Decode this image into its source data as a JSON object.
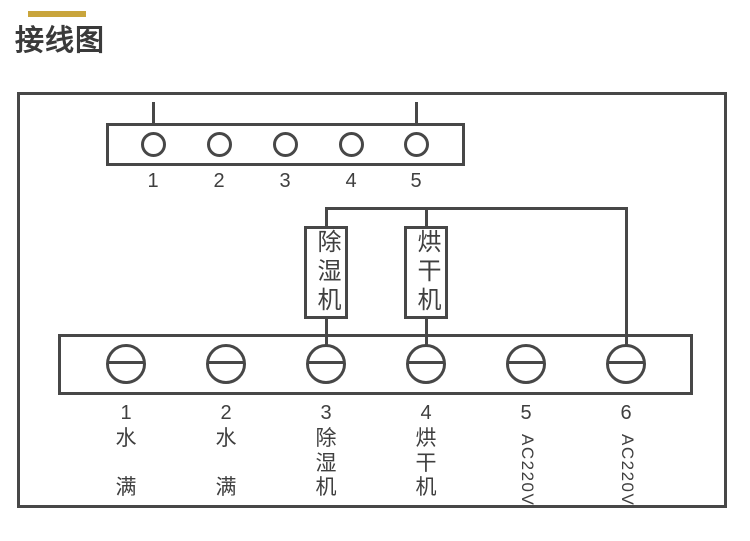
{
  "title": {
    "text": "接线图"
  },
  "colors": {
    "accent": "#C9A53C",
    "line": "#474747",
    "text": "#3F3F3F"
  },
  "top_strip": {
    "terminals": [
      "1",
      "2",
      "3",
      "4",
      "5"
    ]
  },
  "devices": [
    {
      "label": "除湿机"
    },
    {
      "label": "烘干机"
    }
  ],
  "bottom_strip": {
    "terminals": [
      {
        "num": "1",
        "lines": [
          "水",
          "满"
        ]
      },
      {
        "num": "2",
        "lines": [
          "水",
          "满"
        ]
      },
      {
        "num": "3",
        "lines": [
          "除",
          "湿",
          "机"
        ]
      },
      {
        "num": "4",
        "lines": [
          "烘",
          "干",
          "机"
        ]
      },
      {
        "num": "5",
        "rotated": "AC220V"
      },
      {
        "num": "6",
        "rotated": "AC220V"
      }
    ]
  }
}
